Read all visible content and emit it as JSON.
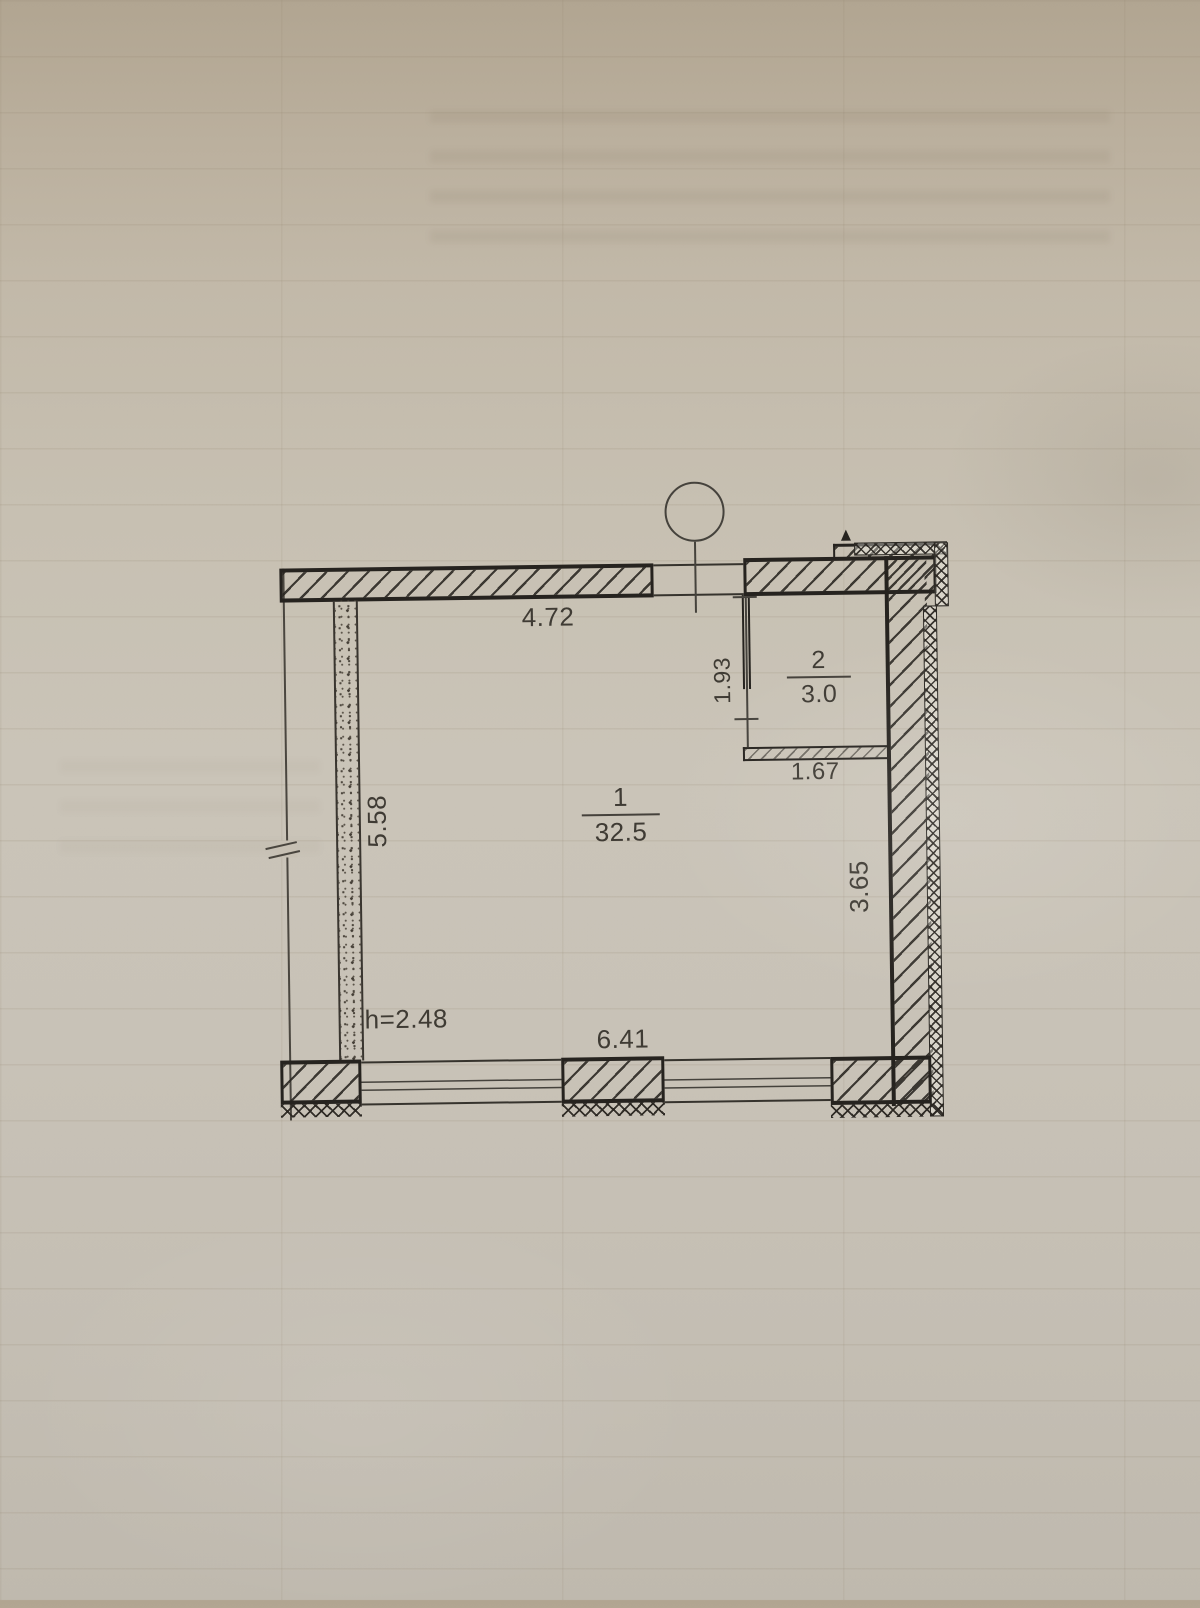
{
  "document": {
    "kind": "floor plan technical drawing (photo of paper sheet)"
  },
  "plan": {
    "labels": {
      "dim_top": "4.72",
      "dim_left": "5.58",
      "dim_room2_depth": "1.93",
      "dim_room2_width": "1.67",
      "dim_right": "3.65",
      "dim_bottom": "6.41",
      "height_note": "h=2.48",
      "room1_number": "1",
      "room1_area": "32.5",
      "room2_number": "2",
      "room2_area": "3.0"
    },
    "colors": {
      "ink": "#2a2722",
      "paper": "#c5beb1",
      "text": "#3f3b34"
    }
  }
}
